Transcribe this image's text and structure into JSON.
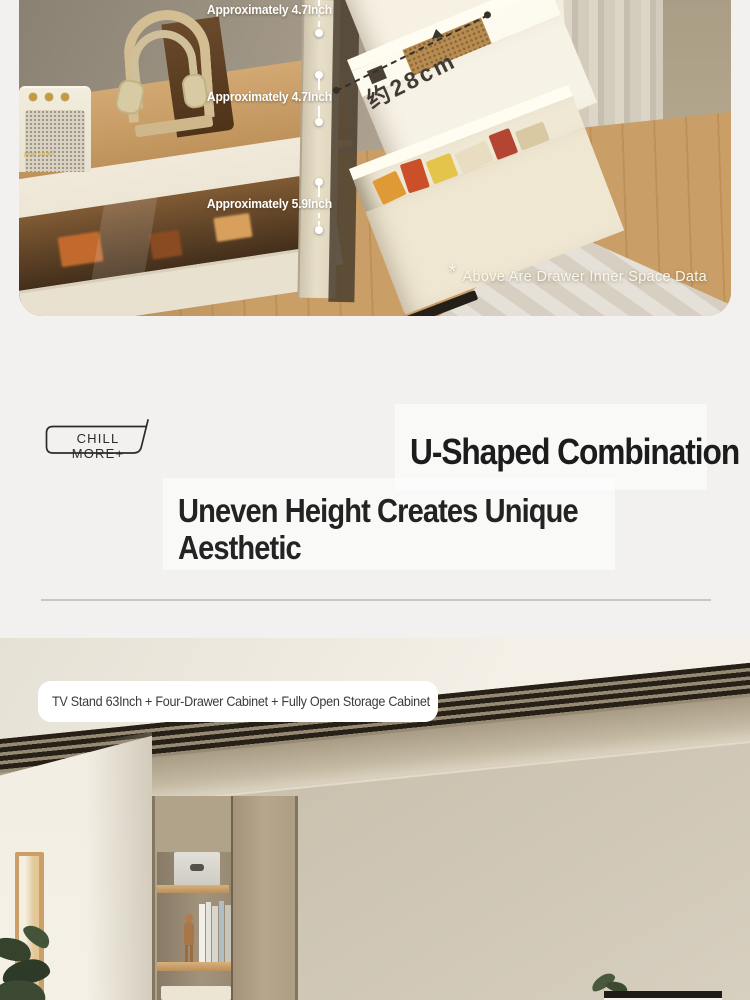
{
  "hero": {
    "measurements": [
      {
        "label": "Approximately 4.7Inch"
      },
      {
        "label": "Approximately 4.7Inch"
      },
      {
        "label": "Approximately 5.9Inch"
      }
    ],
    "depth_label": "约28cm",
    "note_asterisk": "*",
    "note": "Above Are Drawer Inner Space Data",
    "speaker_logo": "Marshall"
  },
  "headline": {
    "badge": "CHILL MORE+",
    "title": "U-Shaped Combination",
    "subtitle_line1": "Uneven Height Creates Unique",
    "subtitle_line2": "Aesthetic"
  },
  "room": {
    "caption": "TV Stand 63Inch + Four-Drawer Cabinet + Fully Open Storage Cabinet"
  },
  "colors": {
    "page_bg": "#f2f1ef",
    "headline_text": "#1c1c1c",
    "annotation_text": "#ffffff",
    "divider": "#c9c7c4",
    "caption_bg": "#ffffff"
  }
}
